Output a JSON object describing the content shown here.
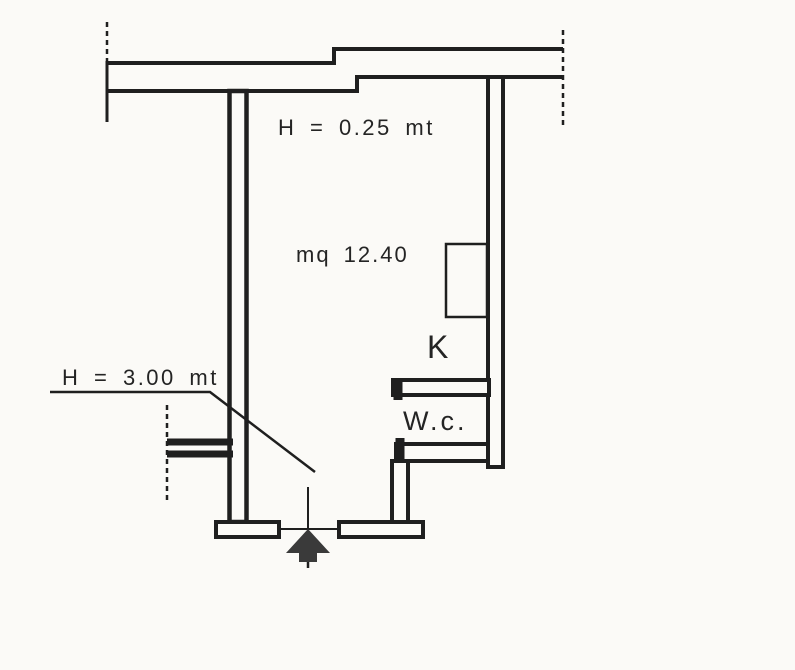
{
  "drawing": {
    "type": "floor-plan",
    "labels": {
      "upper_height": "H = 0.25 mt",
      "area": "mq 12.40",
      "kitchen": "K",
      "wc": "W.c.",
      "room_height": "H = 3.00 mt"
    },
    "colors": {
      "paper": "#fbfaf7",
      "ink": "#1f1f1f",
      "arrow": "#3a3a3a"
    }
  }
}
